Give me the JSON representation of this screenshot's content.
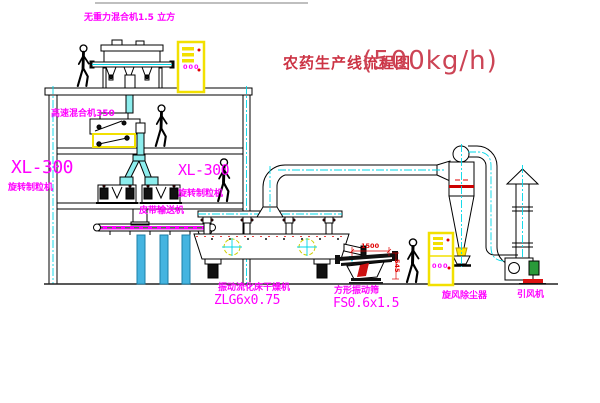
{
  "title": {
    "name": "农药生产线流程图",
    "capacity": "(500kg/h)"
  },
  "equipment_labels": {
    "gravity_mixer": "无重力混合机1.5 立方",
    "high_speed_mixer": "高速混合机350",
    "granulator_left_model": "XL-300",
    "granulator_left_name": "旋转制粒机",
    "granulator_right_model": "XL-300",
    "granulator_right_name": "旋转制粒机",
    "belt_conveyor": "皮带输送机",
    "dryer_name": "振动流化床干燥机",
    "dryer_model": "ZLG6x0.75",
    "screen_name": "方形振动筛",
    "screen_model": "FS0.6x1.5",
    "cyclone_name": "旋风除尘器",
    "fan_name": "引风机"
  },
  "dimensions": {
    "screen_length": "1500",
    "screen_height": "545"
  },
  "cabinet_displays": {
    "top": "000",
    "right": "000"
  },
  "colors": {
    "label_magenta": "#ff00ff",
    "title_red": "#cc3344",
    "dimension_red": "#e00000",
    "centerline_cyan": "#00d8e8",
    "cabinet_yellow": "#f2e000",
    "column_blue": "#45b4e0",
    "motor_green": "#2a9a3a",
    "belt_magenta": "#ff00ff"
  }
}
